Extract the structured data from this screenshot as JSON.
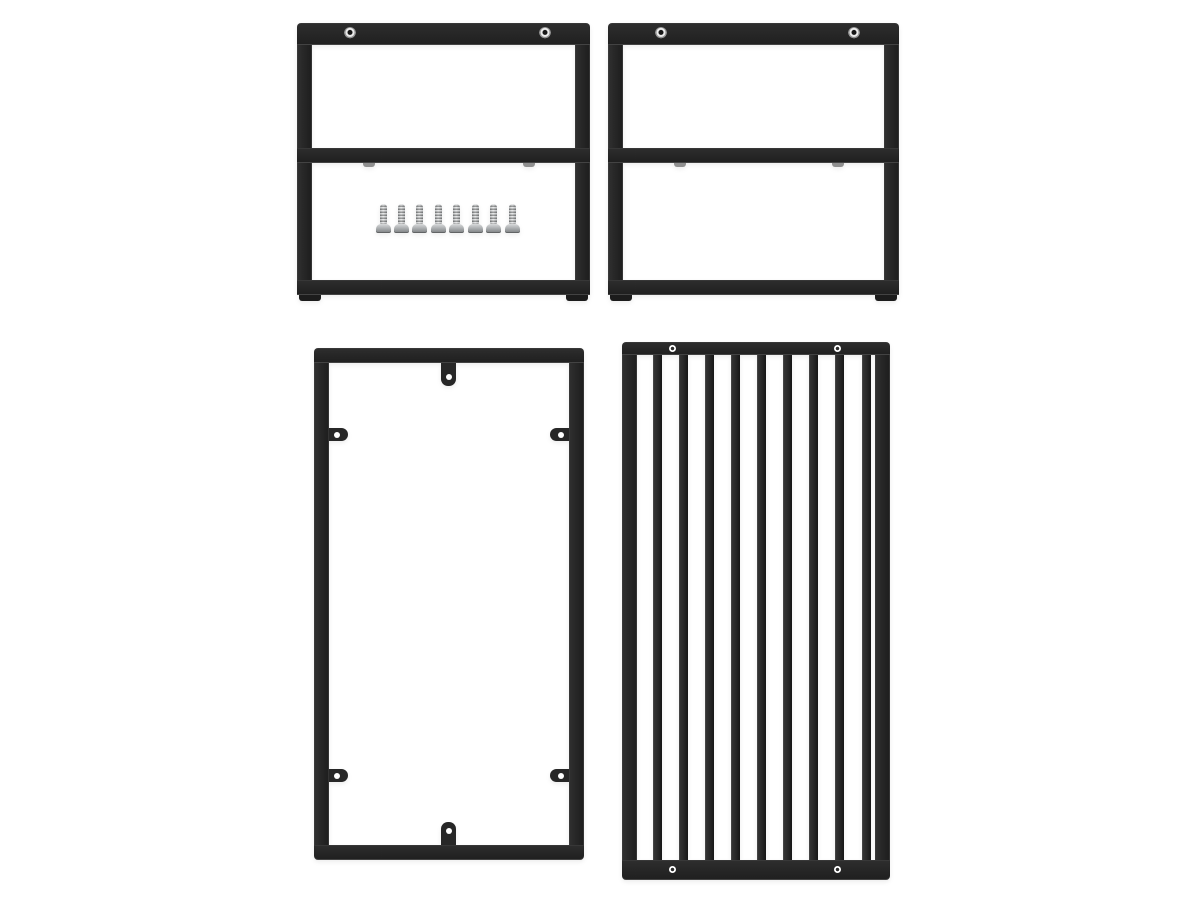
{
  "image": {
    "type": "product-render",
    "background": "#ffffff",
    "description": "Four black powder-coated metal furniture frame parts arranged on a white background: two wide leg frames with crossbars at top, one open tall frame with mounting tabs at bottom left, one slatted tall frame at bottom right, plus loose silver screws"
  },
  "colors": {
    "frame_black": "#272727",
    "background": "#ffffff",
    "screw_silver_light": "#d8dadb",
    "screw_silver_dark": "#8e9294",
    "eyelet_silver": "#ececec",
    "hole_white": "#ffffff",
    "set_screw_gray": "#8f8f8f"
  },
  "parts": [
    {
      "id": "upper-frame-left",
      "label": "wide leg frame with crossbar and loose screws",
      "eyelet_count": 2,
      "set_screw_count": 2,
      "foot_count": 2,
      "screw_count": 8
    },
    {
      "id": "upper-frame-right",
      "label": "wide leg frame with crossbar",
      "eyelet_count": 2,
      "set_screw_count": 2,
      "foot_count": 2,
      "screw_count": 0
    },
    {
      "id": "lower-frame-left",
      "label": "tall open frame with mounting tabs",
      "center_tab_count": 2,
      "side_tab_count": 4,
      "hole_count": 6
    },
    {
      "id": "lower-frame-right",
      "label": "tall slatted frame panel",
      "slat_count": 9,
      "hole_count": 4
    }
  ],
  "hardware": {
    "loose_screws": {
      "count": 8,
      "finish": "silver",
      "style": "pan-head"
    }
  }
}
